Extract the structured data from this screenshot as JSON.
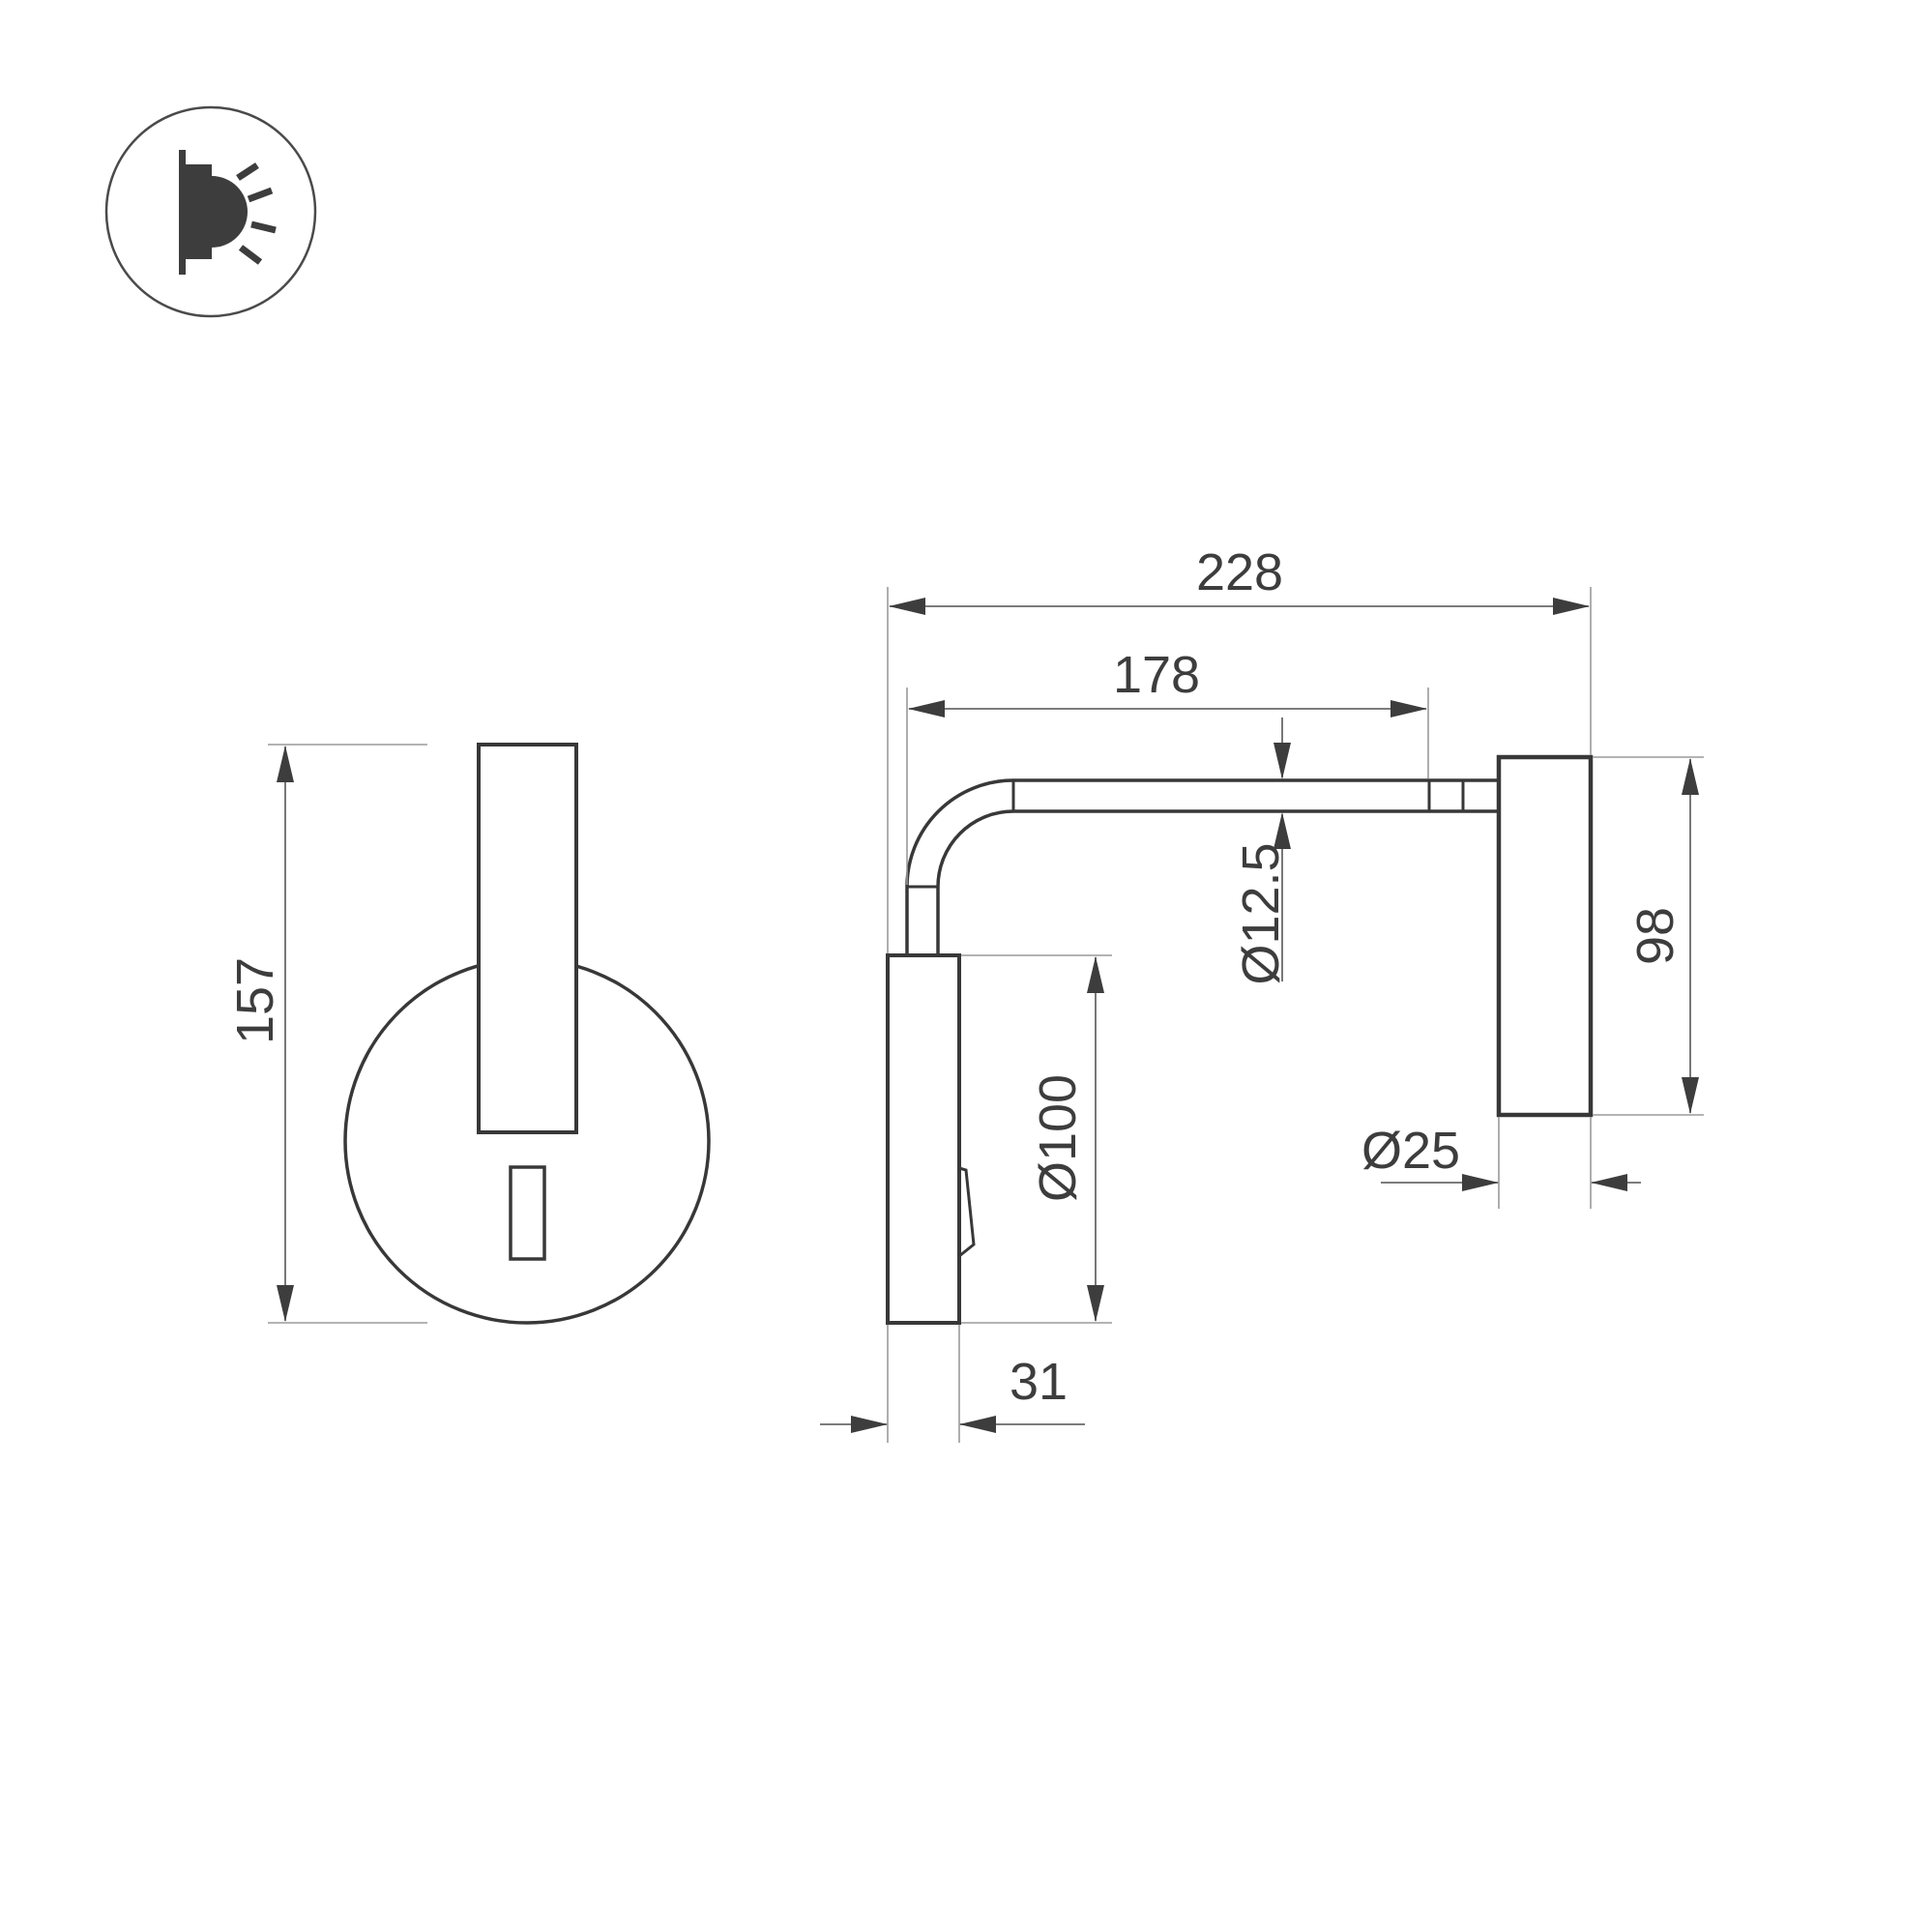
{
  "drawing": {
    "type": "technical-dimension-drawing",
    "subject": "wall-mounted reading lamp, front and side views",
    "background_color": "#ffffff",
    "object_line_color": "#383838",
    "dimension_line_color": "#6a6a6a",
    "extension_line_color": "#9a9a9a",
    "text_color": "#3d3d3d",
    "icon": {
      "name": "wall-light-emission-icon",
      "description": "circle badge with wall-mounted luminaire emitting light rays"
    },
    "dimensions": {
      "front_height": "157",
      "total_depth": "228",
      "arm_length": "178",
      "tube_diameter": "Ø12.5",
      "head_length": "98",
      "base_diameter": "Ø100",
      "head_diameter": "Ø25",
      "base_depth": "31"
    }
  }
}
